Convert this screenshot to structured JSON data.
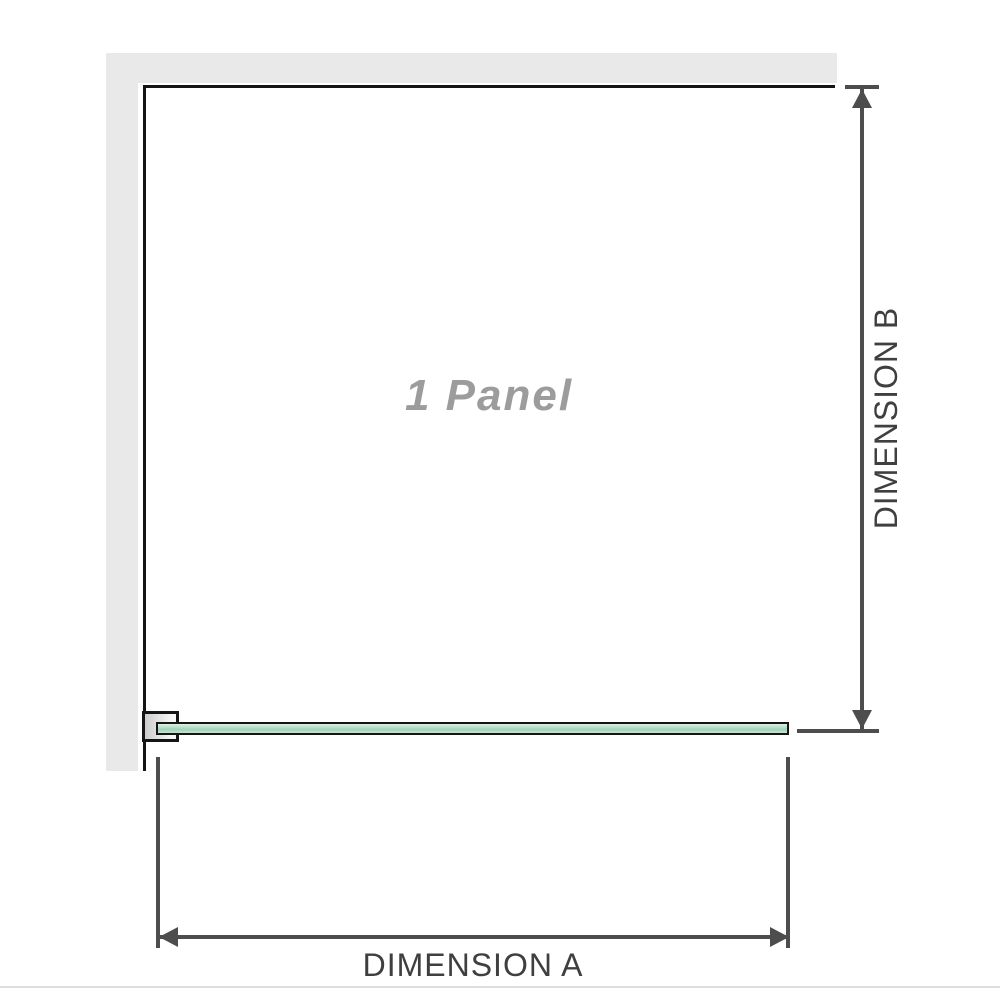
{
  "diagram": {
    "title": "shower panel technical diagram",
    "panel_label": "1 Panel",
    "dimension_a_label": "DIMENSION A",
    "dimension_b_label": "DIMENSION B"
  },
  "colors": {
    "wall_fill": "#e9e9e9",
    "outline_black": "#151515",
    "dimension_line": "#4d4d4d",
    "glass_fill_light": "#dff1e7",
    "glass_fill_main": "#9fd3b7",
    "panel_label_text": "#9c9c9c",
    "dimension_label_text": "#3f3f3f",
    "bottom_edge_line": "#dedede",
    "background": "#ffffff"
  }
}
